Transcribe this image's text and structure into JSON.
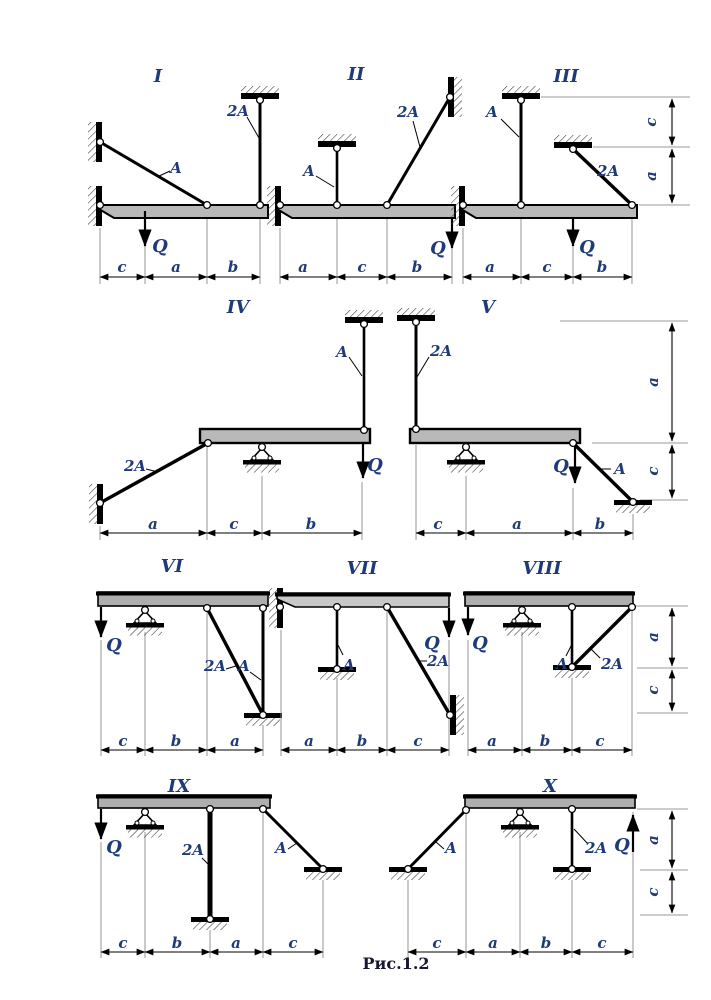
{
  "figure": {
    "caption": "Рис.1.2"
  },
  "colors": {
    "label_blue": "#1e3a78",
    "beam_gray": "#b9b9b9"
  },
  "variants": [
    {
      "numeral": "I",
      "rod_a": "A",
      "rod_2a": "2A",
      "load": "Q",
      "dims": [
        "c",
        "a",
        "b"
      ]
    },
    {
      "numeral": "II",
      "rod_a": "A",
      "rod_2a": "2A",
      "load": "Q",
      "dims": [
        "a",
        "c",
        "b"
      ]
    },
    {
      "numeral": "III",
      "rod_a": "A",
      "rod_2a": "2A",
      "load": "Q",
      "dims": [
        "a",
        "c",
        "b"
      ],
      "vdims": [
        "c",
        "a"
      ]
    },
    {
      "numeral": "IV",
      "rod_a": "A",
      "rod_2a": "2A",
      "load": "Q",
      "dims": [
        "a",
        "c",
        "b"
      ]
    },
    {
      "numeral": "V",
      "rod_a": "A",
      "rod_2a": "2A",
      "load": "Q",
      "dims": [
        "c",
        "a",
        "b"
      ],
      "vdims": [
        "a",
        "c"
      ]
    },
    {
      "numeral": "VI",
      "rod_a": "A",
      "rod_2a": "2A",
      "load": "Q",
      "dims": [
        "c",
        "b",
        "a"
      ]
    },
    {
      "numeral": "VII",
      "rod_a": "A",
      "rod_2a": "2A",
      "load": "Q",
      "dims": [
        "a",
        "b",
        "c"
      ]
    },
    {
      "numeral": "VIII",
      "rod_a": "A",
      "rod_2a": "2A",
      "load": "Q",
      "dims": [
        "a",
        "b",
        "c"
      ],
      "vdims": [
        "a",
        "c"
      ]
    },
    {
      "numeral": "IX",
      "rod_a": "A",
      "rod_2a": "2A",
      "load": "Q",
      "dims": [
        "c",
        "b",
        "a",
        "c"
      ]
    },
    {
      "numeral": "X",
      "rod_a": "A",
      "rod_2a": "2A",
      "load": "Q",
      "dims": [
        "c",
        "a",
        "b",
        "c"
      ],
      "vdims": [
        "a",
        "c"
      ]
    }
  ]
}
